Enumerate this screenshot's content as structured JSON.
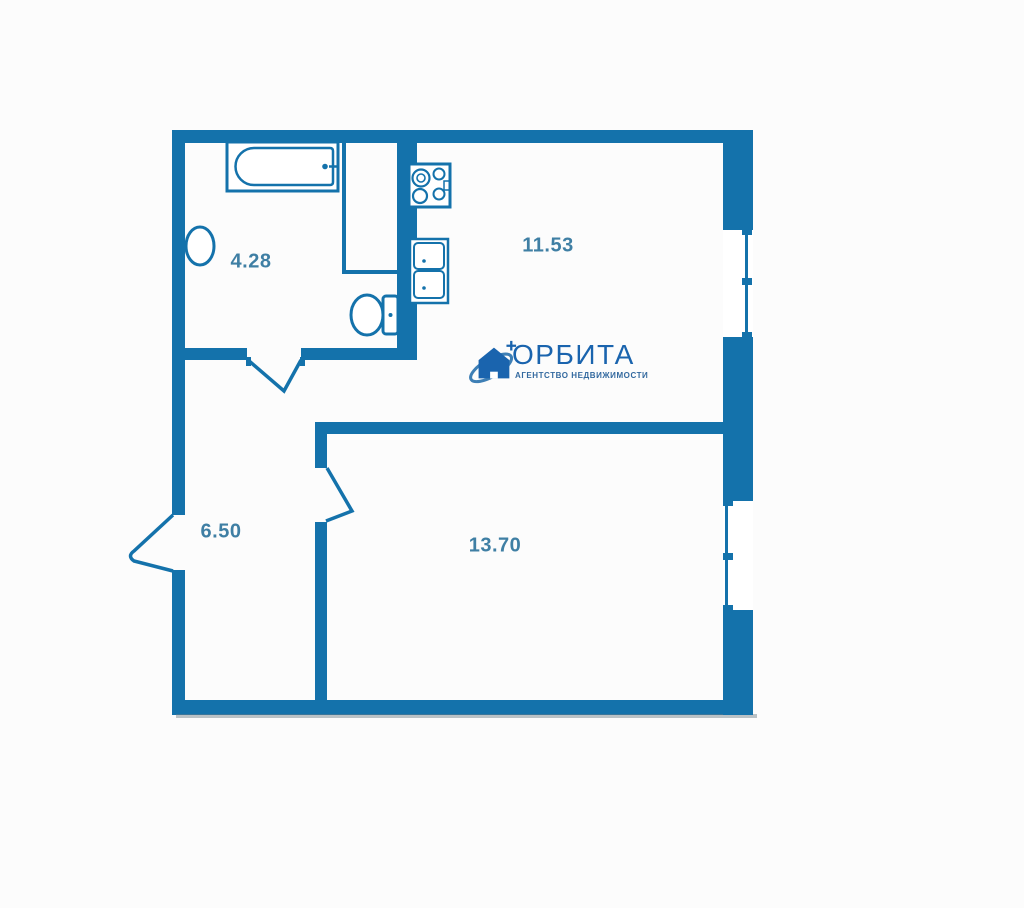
{
  "title": "Floor plan",
  "colors": {
    "wall": "#1472ab",
    "label": "#3f7fa4",
    "logo": "#1a64ae",
    "tagline": "#33699f",
    "background": "#fcfcfc"
  },
  "plan": {
    "rooms": [
      {
        "name": "bathroom",
        "area_label": "4.28"
      },
      {
        "name": "kitchen-living",
        "area_label": "11.53"
      },
      {
        "name": "hallway",
        "area_label": "6.50"
      },
      {
        "name": "bedroom",
        "area_label": "13.70"
      }
    ],
    "fixtures": [
      "bathtub",
      "wash-basin",
      "toilet",
      "cooktop",
      "double-sink"
    ],
    "openings": [
      "entrance-door",
      "bathroom-door",
      "room-door",
      "window-upper",
      "window-lower"
    ]
  },
  "logo": {
    "brand": "ОРБИТА",
    "tagline": "АГЕНТСТВО НЕДВИЖИМОСТИ"
  }
}
